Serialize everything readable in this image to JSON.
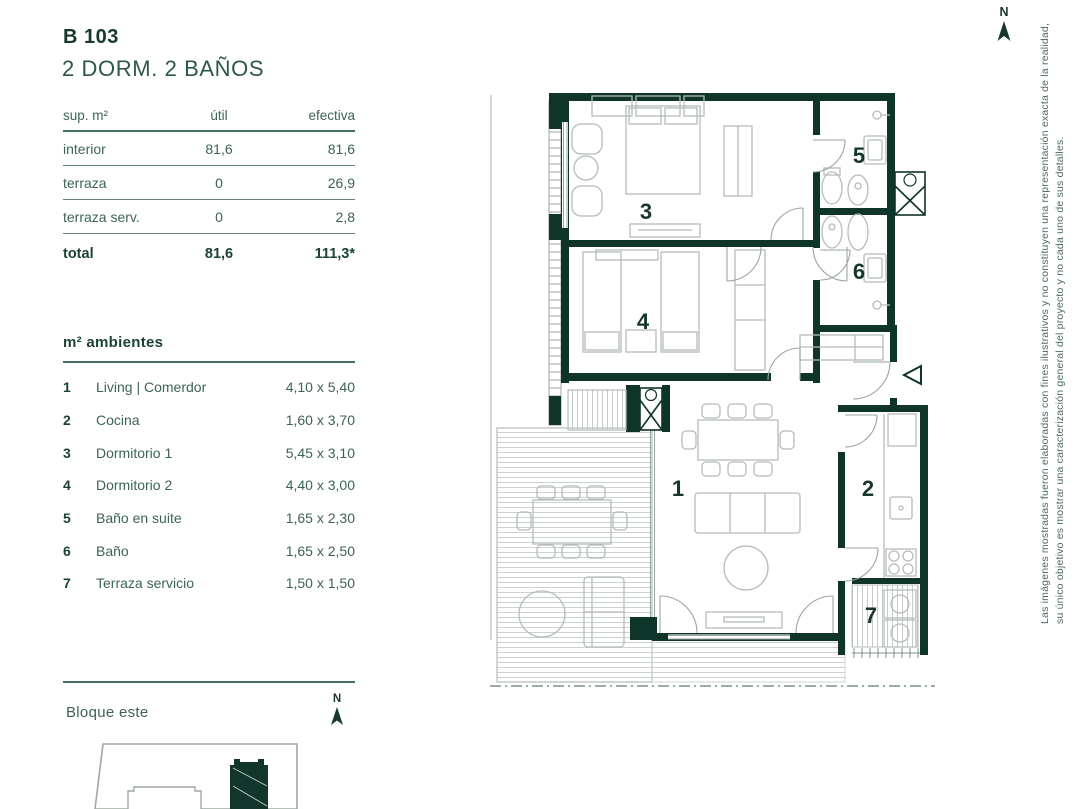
{
  "unit": {
    "code": "B 103",
    "subtitle": "2 DORM. 2 BAÑOS"
  },
  "surface_table": {
    "header": {
      "col1": "sup. m²",
      "col2": "útil",
      "col3": "efectiva"
    },
    "rows": [
      {
        "label": "interior",
        "util": "81,6",
        "efectiva": "81,6"
      },
      {
        "label": "terraza",
        "util": "0",
        "efectiva": "26,9"
      },
      {
        "label": "terraza serv.",
        "util": "0",
        "efectiva": "2,8"
      }
    ],
    "total": {
      "label": "total",
      "util": "81,6",
      "efectiva": "111,3*"
    }
  },
  "ambientes": {
    "title": "m² ambientes",
    "items": [
      {
        "num": "1",
        "name": "Living | Comerdor",
        "dims": "4,10 x 5,40"
      },
      {
        "num": "2",
        "name": "Cocina",
        "dims": "1,60 x 3,70"
      },
      {
        "num": "3",
        "name": "Dormitorio 1",
        "dims": "5,45 x 3,10"
      },
      {
        "num": "4",
        "name": "Dormitorio 2",
        "dims": "4,40 x 3,00"
      },
      {
        "num": "5",
        "name": "Baño en suite",
        "dims": "1,65 x 2,30"
      },
      {
        "num": "6",
        "name": "Baño",
        "dims": "1,65 x 2,50"
      },
      {
        "num": "7",
        "name": "Terraza servicio",
        "dims": "1,50 x 1,50"
      }
    ]
  },
  "block": {
    "label": "Bloque este"
  },
  "compass": {
    "label": "N"
  },
  "floorplan": {
    "rooms": {
      "r1": "1",
      "r2": "2",
      "r3": "3",
      "r4": "4",
      "r5": "5",
      "r6": "6",
      "r7": "7"
    }
  },
  "disclaimer": {
    "line1": "Las imágenes mostradas fueron elaboradas con fines ilustrativos y no constituyen una representación exacta de la realidad,",
    "line2": "su único objetivo es mostrar una caracterización general del proyecto y no cada uno de sus detalles."
  },
  "colors": {
    "wall": "#0f342a",
    "heading": "#1c4237",
    "body_text": "#3c6359",
    "furniture": "#b5bcb9"
  }
}
